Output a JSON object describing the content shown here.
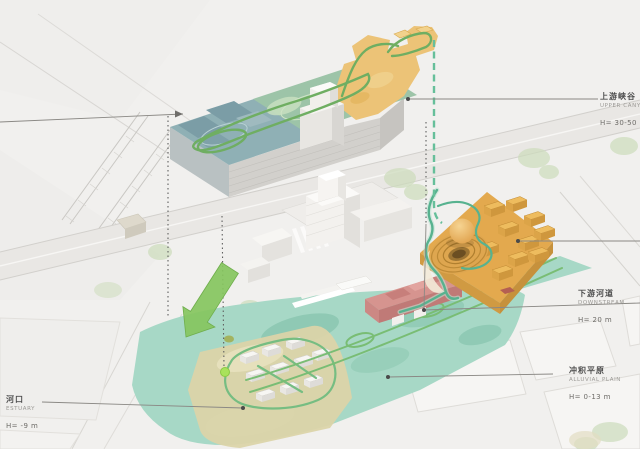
{
  "diagram": {
    "kind": "axonometric-site-strategy-diagram",
    "zones": [
      "upper_canyon",
      "downstream",
      "alluvial_plain",
      "estuary"
    ]
  },
  "labels": {
    "upper_canyon": {
      "zh": "上游峡谷",
      "en": "UPPER CANYON",
      "height": "H= 30-50 m"
    },
    "downstream": {
      "zh": "下游河道",
      "en": "DOWNSTREAM",
      "height": "H= 20 m"
    },
    "alluvial_plain": {
      "zh": "冲积平原",
      "en": "ALLUVIAL PLAIN",
      "height": "H= 0-13 m"
    },
    "estuary": {
      "zh": "河口",
      "en": "ESTUARY",
      "height": "H= -9 m"
    }
  },
  "colors": {
    "background": "#f1f0ee",
    "blue_roof": "#8fb0b5",
    "terrace_roof_green": "#9dc4a8",
    "canyon_roof_yellow": "#ecc377",
    "orange_complex": "#e3a94e",
    "pink_building": "#d6948f",
    "plain_teal": "#a7d8c6",
    "estuary_tan": "#dbd4a9",
    "path_green": "#6fae62",
    "route_teal": "#5cb896",
    "arrow_green": "#85c55e",
    "annotation_grey": "#8a8884"
  }
}
